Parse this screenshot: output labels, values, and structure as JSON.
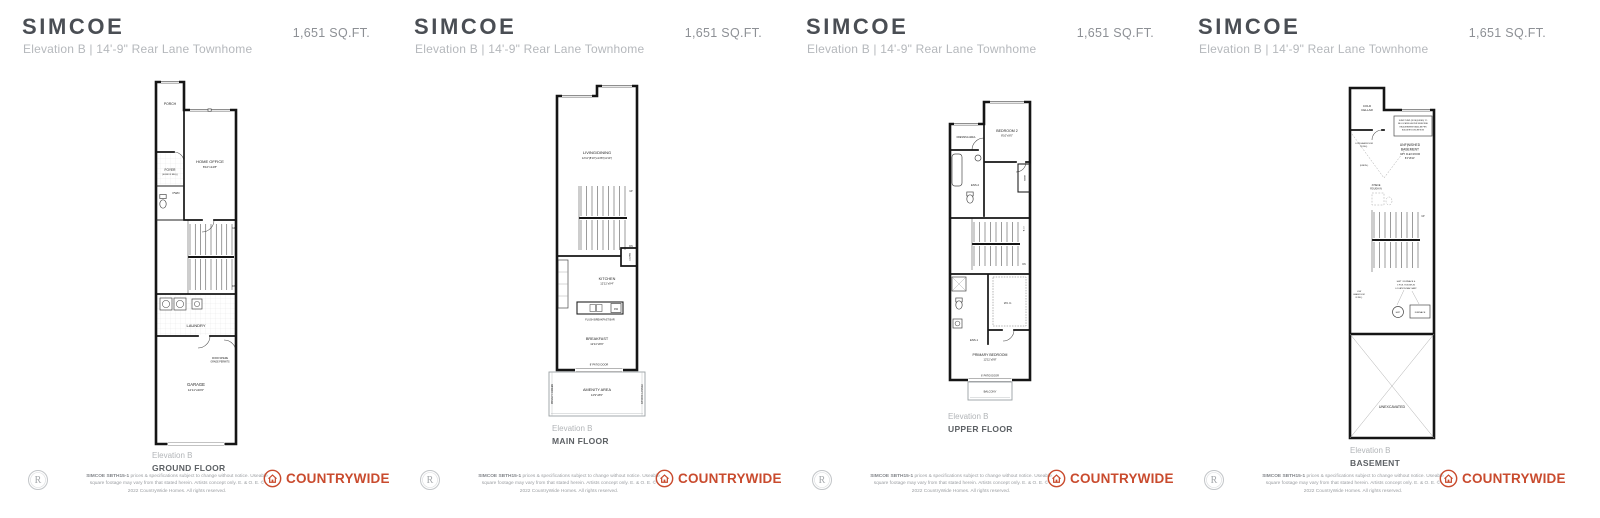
{
  "panels": [
    {
      "title": "SIMCOE",
      "subtitle": "Elevation B  |  14'-9\" Rear Lane Townhome",
      "sqft": "1,651 SQ.FT.",
      "caption_elevation": "Elevation B",
      "caption_floor": "GROUND FLOOR",
      "plan": {
        "porch": "PORCH",
        "foyer": "FOYER",
        "foyer_note": "(SUNK IF REQ.)",
        "home_office": "HOME OFFICE",
        "home_office_dims": "8'10\"x14'8\"",
        "pwd": "PWD",
        "up": "UP",
        "dn": "DN",
        "laundry": "LAUNDRY",
        "door_note1": "DOOR WHERE",
        "door_note2": "GRADE PERMITS",
        "garage": "GARAGE",
        "garage_dims": "12'11\"x20'0\""
      }
    },
    {
      "title": "SIMCOE",
      "subtitle": "Elevation B  |  14'-9\" Rear Lane Townhome",
      "sqft": "1,651 SQ.FT.",
      "caption_elevation": "Elevation B",
      "caption_floor": "MAIN FLOOR",
      "plan": {
        "living": "LIVING/DINING",
        "living_dims": "12'11\"(8'10\")x14'8\"(11'10\")",
        "up": "UP",
        "dn": "DN",
        "pantry": "PANTRY",
        "kitchen": "KITCHEN",
        "kitchen_dims": "12'11\"x9'4\"",
        "dw": "DW",
        "breakfast_bar": "FLUSH BREAKFAST BAR",
        "breakfast": "BREAKFAST",
        "breakfast_dims": "12'11\"x8'0\"",
        "patio_door": "8' PATIO DOOR",
        "amenity": "AMENITY AREA",
        "amenity_dims": "14'9\"x8'0\"",
        "privacy": "PRIVACY SCREEN"
      }
    },
    {
      "title": "SIMCOE",
      "subtitle": "Elevation B  |  14'-9\" Rear Lane Townhome",
      "sqft": "1,651 SQ.FT.",
      "caption_elevation": "Elevation B",
      "caption_floor": "UPPER FLOOR",
      "plan": {
        "dressing": "DRESSING AREA",
        "bedroom2": "BEDROOM 2",
        "bedroom2_dims": "8'10\"x9'0\"",
        "ens2": "ENS.2",
        "linen": "LINEN",
        "otb": "O.T.B.",
        "dn": "DN",
        "ens1": "ENS.1",
        "wic": "W.I.C.",
        "primary": "PRIMARY BEDROOM",
        "primary_dims": "12'11\"x9'8\"",
        "patio_door": "6' PATIO DOOR",
        "balcony": "BALCONY"
      }
    },
    {
      "title": "SIMCOE",
      "subtitle": "Elevation B  |  14'-9\" Rear Lane Townhome",
      "sqft": "1,651 SQ.FT.",
      "caption_elevation": "Elevation B",
      "caption_floor": "BASEMENT",
      "plan": {
        "cold1": "COLD",
        "cold2": "CELLAR",
        "sump1": "SUMP PUMP (IF REQUIRED) TO",
        "sump2": "BE LOCATED AS PER MUNICIPAL",
        "sump3": "REQUIREMENTS AND AS PER",
        "sump4": "BUILDER'S DISCRETION",
        "low1": "LOW HEADROOM",
        "low2": "IF REQ.",
        "unfin": "(UNFIN.)",
        "ub1": "UNFINISHED",
        "ub2": "BASEMENT",
        "ub3": "OPT. FLEX ROOM",
        "ub_dims": "8'4\"x8'11\"",
        "rough1": "3 PIECE",
        "rough2": "ROUGH IN",
        "up": "UP",
        "note1": "HWT / FURNACE &",
        "note2": "3 PCE. ROUGH-IN",
        "note3": "LOCATION MAY VARY",
        "lowb1": "LOW",
        "lowb2": "HEADROOM",
        "lowb3": "IF REQ.",
        "hwt": "HWT",
        "furnace": "FURNACE",
        "unexcavated": "UNEXCAVATED"
      }
    }
  ],
  "footer": {
    "badge_letter": "R",
    "disclaimer_bold": "SIMCOE SBTH15-1",
    "disclaimer_rest": "prices & specifications subject to change without notice. Useable square footage may vary from that stated herein. Artists concept only. E. & O. E. © 2022 CountryWide Homes. All rights reserved.",
    "brand_part1": "COUNTRY",
    "brand_part2": "WIDE",
    "brand_color": "#c94b2e"
  }
}
